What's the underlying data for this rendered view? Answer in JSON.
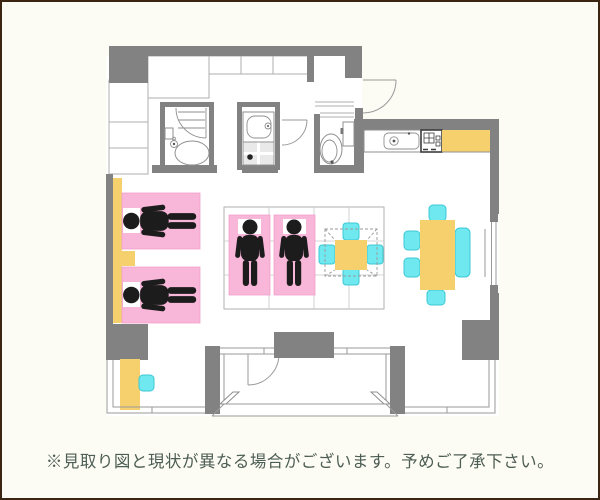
{
  "caption": {
    "text": "※見取り図と現状が異なる場合がございます。予めご了承下さい。"
  },
  "palette": {
    "bg": "#FCFBF4",
    "frame": "#3B2513",
    "wall": "#828282",
    "line": "#AFAFAF",
    "fixture": "#8F8F8F",
    "pink": "#F8B6D9",
    "pink_edge": "#F0A1CB",
    "yellow": "#F5D06C",
    "cyan": "#6FE8EF",
    "cyan_edge": "#3CC8D4",
    "black": "#1C1C1C",
    "pan": "#E9E9E9",
    "caption": "#4D5E54"
  },
  "floorplan": {
    "elements": [
      "closet",
      "bathtub",
      "bathroom-door",
      "washbasin",
      "washing-machine-pan",
      "toilet",
      "entrance-door",
      "hallway-door",
      "kitchen-sink",
      "gas-stove",
      "kitchen-counter",
      "single-bed",
      "person-lying",
      "nightstand",
      "futon",
      "person-standing",
      "kotatsu-table",
      "floor-cushion",
      "dining-table",
      "dining-chair",
      "dining-bench",
      "desk",
      "desk-chair",
      "air-conditioner-unit",
      "balcony",
      "sliding-window",
      "window",
      "wall-counter"
    ]
  }
}
